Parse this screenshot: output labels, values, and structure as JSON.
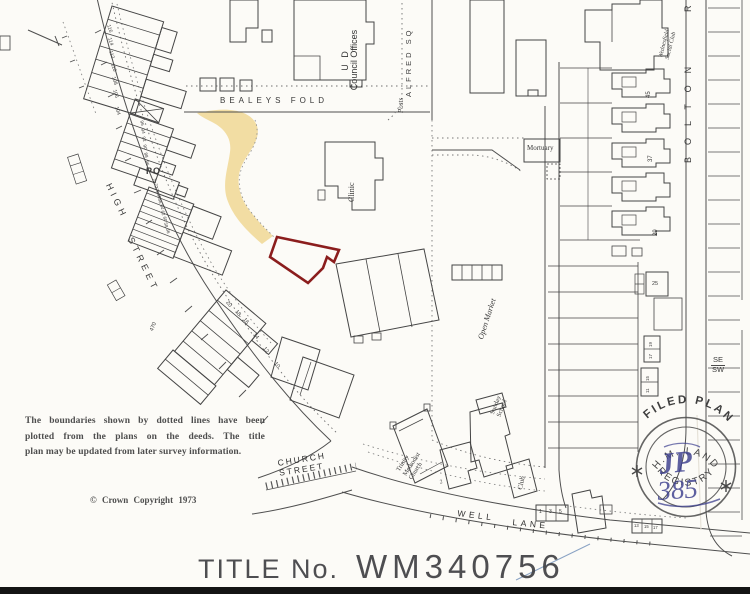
{
  "title_block": {
    "label": "TITLE No.",
    "number": "WM340756"
  },
  "disclaimer": {
    "line1": "The boundaries shown by dotted lines have been",
    "line2": "plotted from the plans on the deeds.  The title",
    "line3": "plan may be updated from later survey information.",
    "copyright": "©  Crown Copyright  1973"
  },
  "streets": {
    "bealeys_fold": "BEALEYS  FOLD",
    "high": "HIGH",
    "street": "STREET",
    "alfred_sq": "ALFRED  SQ",
    "bolton": "BOLTON",
    "bolton_partial": "R",
    "church": "CHURCH",
    "church_street": "STREET",
    "well": "WELL",
    "lane": "LANE"
  },
  "places": {
    "ud": "U D",
    "council_offices": "Council Offices",
    "clinic": "Clinic",
    "mortuary": "Mortuary",
    "posts": "Posts",
    "po": "PO",
    "open_market": "Open Market",
    "sunday": "Sunday",
    "school": "School",
    "trinity": "Trinity",
    "methodist": "Methodist",
    "church": "Church",
    "club": "Club",
    "social_club_l1": "Wednesfield",
    "social_club_l2": "Social Club"
  },
  "stamp": {
    "filed_plan": "FILED   PLAN",
    "hm_land": "H.M.  LAND",
    "registry": "REGISTRY",
    "ink_monogram": "JP",
    "ink_number": "385",
    "star_icon": "asterisk-star"
  },
  "compass": {
    "se": "SE",
    "sw": "SW"
  },
  "numbers": {
    "terrace_top": [
      "116",
      "114",
      "112",
      "110",
      "108",
      "106",
      "104"
    ],
    "terrace_mid": [
      "96",
      "94",
      "92",
      "90",
      "88",
      "86"
    ],
    "terrace_low": [
      "74",
      "72",
      "70",
      "68",
      "66",
      "64",
      "62",
      "60",
      "58",
      "56"
    ],
    "terrace_bottom": [
      "20",
      "18",
      "16",
      "14",
      "12",
      "10"
    ],
    "east_45": "45",
    "east_37": "37",
    "east_29": "29",
    "east_25": "25",
    "east_19": "19",
    "east_17": "17",
    "east_15": "15",
    "east_11": "11",
    "well_north": [
      "1",
      "3",
      "5"
    ],
    "well_south": [
      "13",
      "15",
      "17"
    ],
    "church_plot": "2",
    "spot_height": "470"
  },
  "colors": {
    "parcel_red": "#8b1d1d",
    "tint_yellow": "#f1db9e",
    "ink_blue": "#3c3f8e",
    "map_line": "#4c4c4c"
  }
}
